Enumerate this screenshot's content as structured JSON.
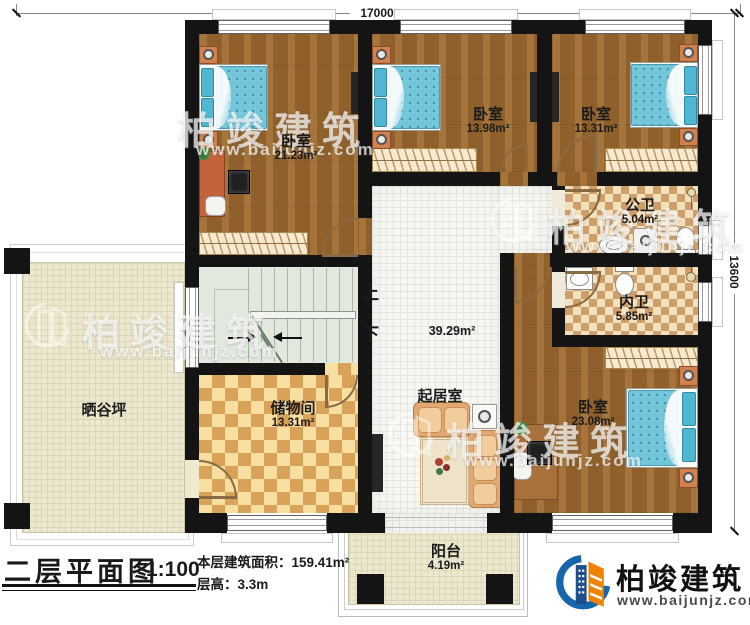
{
  "title_block": {
    "title": "二层平面图",
    "scale": "1:100",
    "floor_area_label": "本层建筑面积：",
    "floor_area_value": "159.41m²",
    "floor_height_label": "层高：",
    "floor_height_value": "3.3m"
  },
  "brand": {
    "name": "柏竣建筑",
    "website": "www.baijunjz.com"
  },
  "watermark": {
    "name": "柏竣建筑",
    "website": "www.baijunjz.com"
  },
  "dimensions": {
    "top": "17000",
    "right": "13600"
  },
  "stairs": {
    "up_label": "上",
    "down_label": "下"
  },
  "rooms": {
    "bedroom_nw": {
      "name": "卧室",
      "area": "21.23m²"
    },
    "bedroom_n": {
      "name": "卧室",
      "area": "13.98m²"
    },
    "bedroom_ne": {
      "name": "卧室",
      "area": "13.31m²"
    },
    "bedroom_se": {
      "name": "卧室",
      "area": "23.08m²"
    },
    "public_bathroom": {
      "name": "公卫",
      "area": "5.04m²"
    },
    "private_bathroom": {
      "name": "内卫",
      "area": "5.85m²"
    },
    "living_room": {
      "name": "起居室",
      "area": "39.29m²"
    },
    "storage_room": {
      "name": "储物间",
      "area": "13.31m²"
    },
    "drying_yard": {
      "name": "晒谷坪"
    },
    "balcony": {
      "name": "阳台",
      "area": "4.19m²"
    }
  },
  "colors": {
    "wall": "#141414",
    "wood_floor": "#9a672e",
    "bath_tile": "#cf9f6b",
    "bed_blue": "#74c6da",
    "brand_blue": "#1766ad",
    "brand_orange": "#ef8200"
  }
}
